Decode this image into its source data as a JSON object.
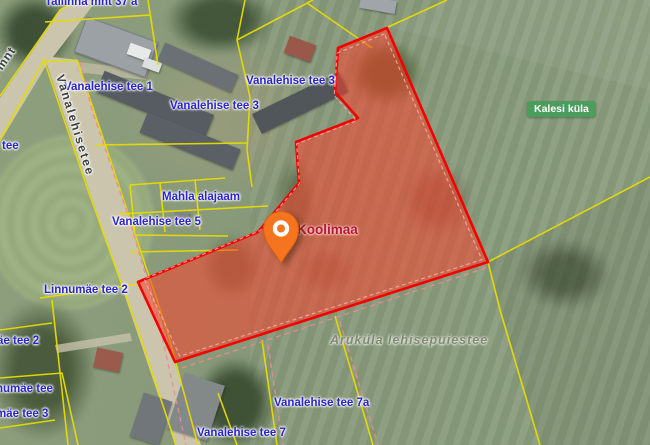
{
  "map": {
    "address_labels": [
      {
        "text": "Tallinna mnt 37 a"
      },
      {
        "text": "Vanalehise tee 1"
      },
      {
        "text": "Vanalehise tee 3"
      },
      {
        "text": "Vanalehise tee 3"
      },
      {
        "text": "tee"
      },
      {
        "text": "Mahla alajaam"
      },
      {
        "text": "Vanalehise tee 5"
      },
      {
        "text": "Linnumäe tee 2"
      },
      {
        "text": "äe tee 2"
      },
      {
        "text": "numäe tee"
      },
      {
        "text": "mäe tee 3"
      },
      {
        "text": "Vanalehise tee 7a"
      },
      {
        "text": "Vanalehise tee 7"
      }
    ],
    "road_labels": {
      "main_street": "Vanalehisetee",
      "highway": "Tallinna mnt"
    },
    "selected_parcel": {
      "name": "Koolimaa"
    },
    "village_badge": {
      "text": "Kalesi küla"
    },
    "nature_area": {
      "text": "Aruküla lehisepuiestee"
    },
    "colors": {
      "selected_parcel_outline": "#f50000",
      "selected_parcel_fill": "rgba(248,65,44,0.55)",
      "cadastral_line": "#e6dc00",
      "utility_dash_line": "#ef8a8a",
      "address_label": "#2b25cc",
      "parcel_name_label": "#b81635",
      "village_badge_bg": "#4a9d5c",
      "pin": "#f4741f"
    }
  }
}
